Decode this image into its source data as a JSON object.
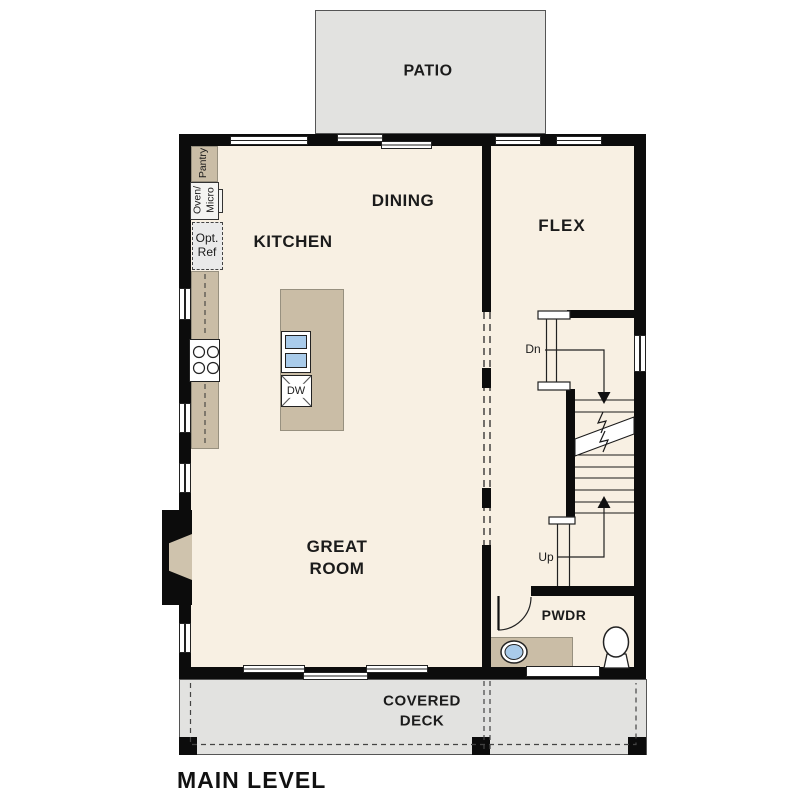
{
  "title": "MAIN LEVEL",
  "colors": {
    "floor": "#f8f0e3",
    "outdoor_gray": "#e2e2e0",
    "cabinet_tan": "#cabda6",
    "sink_blue": "#a9cbea",
    "wall": "#0c0c0c",
    "text": "#1b1b1b"
  },
  "rooms": {
    "patio": "PATIO",
    "dining": "DINING",
    "kitchen": "KITCHEN",
    "flex": "FLEX",
    "great_room": [
      "GREAT",
      "ROOM"
    ],
    "pwdr": "PWDR",
    "covered_deck": [
      "COVERED",
      "DECK"
    ]
  },
  "fixtures": {
    "pantry": "Pantry",
    "oven": "Oven/",
    "micro": "Micro",
    "opt_ref": [
      "Opt.",
      "Ref"
    ],
    "dishwasher": "DW",
    "stairs_down": "Dn",
    "stairs_up": "Up"
  }
}
